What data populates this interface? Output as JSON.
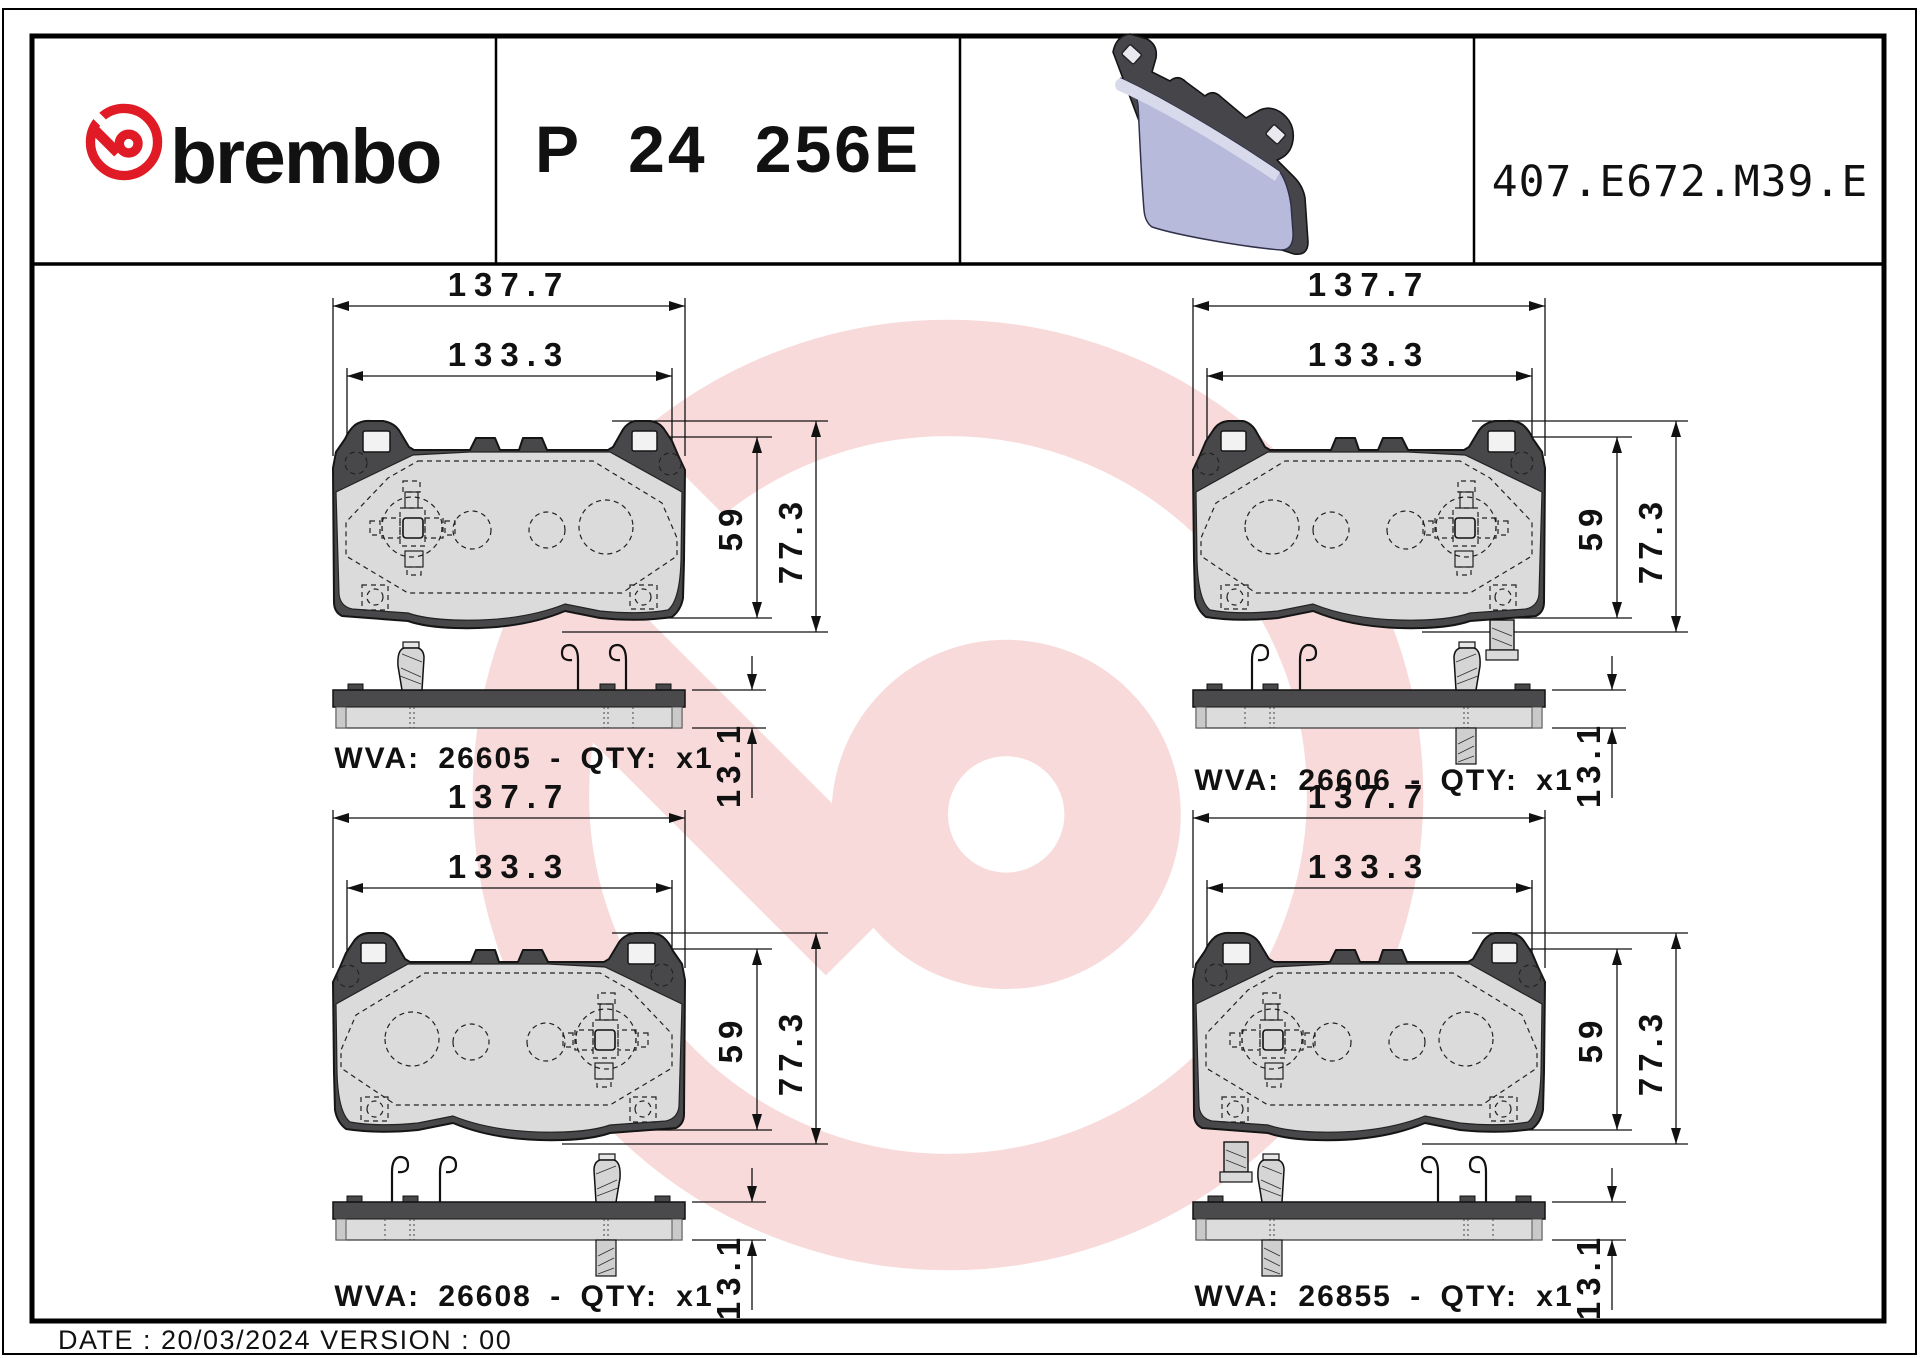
{
  "header": {
    "brand_wordmark": "brembo",
    "part_number": "P 24 256E",
    "reference_code": "407.E672.M39.E"
  },
  "quadrants": [
    {
      "position": "top-left",
      "wva_label": "WVA: 26605 - QTY: x1",
      "dims": {
        "overall_width": "137.7",
        "pad_width": "133.3",
        "pad_height": "59",
        "overall_height": "77.3",
        "thickness": "13.1"
      }
    },
    {
      "position": "top-right",
      "wva_label": "WVA: 26606 - QTY: x1",
      "dims": {
        "overall_width": "137.7",
        "pad_width": "133.3",
        "pad_height": "59",
        "overall_height": "77.3",
        "thickness": "13.1"
      }
    },
    {
      "position": "bottom-left",
      "wva_label": "WVA: 26608 - QTY: x1",
      "dims": {
        "overall_width": "137.7",
        "pad_width": "133.3",
        "pad_height": "59",
        "overall_height": "77.3",
        "thickness": "13.1"
      }
    },
    {
      "position": "bottom-right",
      "wva_label": "WVA: 26855 - QTY: x1",
      "dims": {
        "overall_width": "137.7",
        "pad_width": "133.3",
        "pad_height": "59",
        "overall_height": "77.3",
        "thickness": "13.1"
      }
    }
  ],
  "footer": {
    "date_version_line": "DATE : 20/03/2024 VERSION : 00"
  },
  "colors": {
    "brand_red": "#e01b26",
    "watermark_pink": "#f8dada",
    "backing_gray": "#48484a",
    "friction_gray": "#dbdbdb",
    "render_lavender": "#b7badb"
  }
}
